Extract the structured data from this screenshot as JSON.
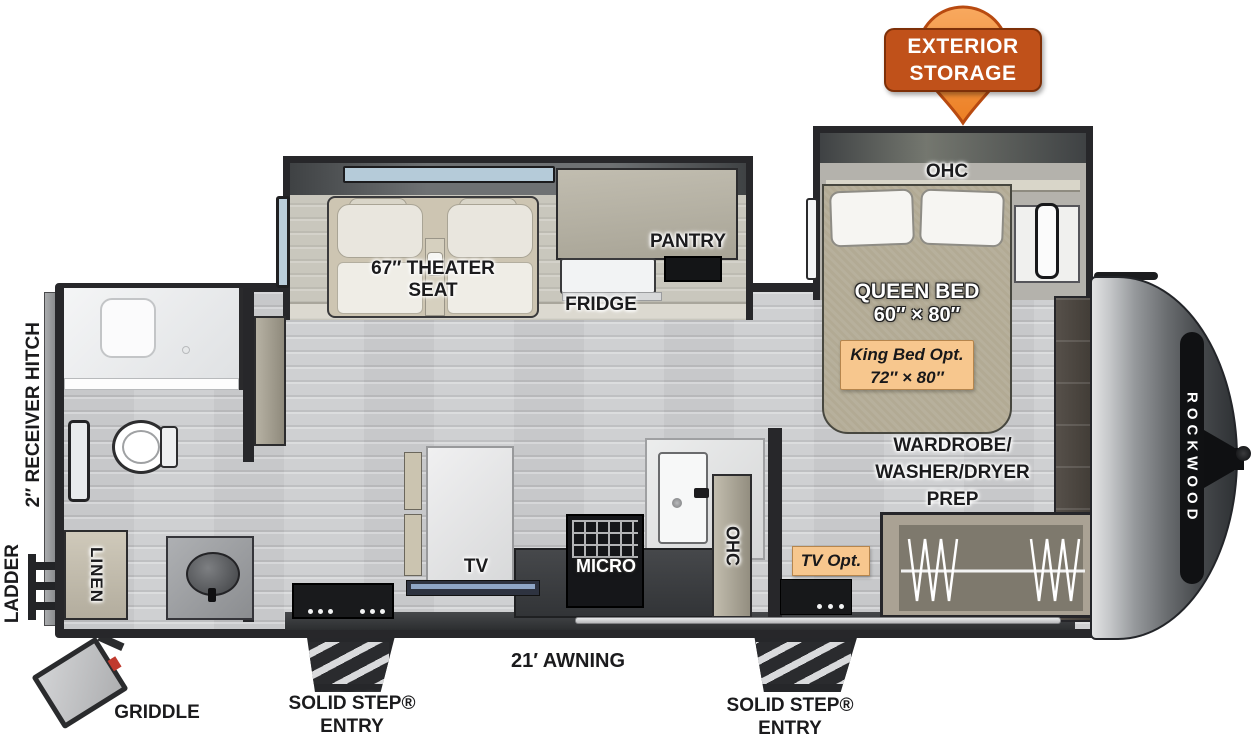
{
  "callout": {
    "lines": [
      "EXTERIOR",
      "STORAGE"
    ]
  },
  "bedroom": {
    "ohc": "OHC",
    "queen_bed": "QUEEN BED",
    "queen_size": "60″ × 80″",
    "king_opt": "King Bed Opt.",
    "king_size": "72″ × 80″",
    "wardrobe": [
      "WARDROBE/",
      "WASHER/DRYER",
      "PREP"
    ],
    "tv_opt": "TV Opt."
  },
  "living": {
    "theater": [
      "67″ THEATER",
      "SEAT"
    ],
    "pantry": "PANTRY",
    "fridge": "FRIDGE",
    "tv": "TV",
    "micro": "MICRO",
    "ohc": "OHC"
  },
  "bath": {
    "linen": "LINEN"
  },
  "exterior": {
    "ladder": "LADDER",
    "hitch": "2″ RECEIVER HITCH",
    "griddle": "GRIDDLE",
    "awning": "21′ AWNING",
    "entry": [
      "SOLID STEP®",
      "ENTRY"
    ],
    "brand": "ROCKWOOD"
  },
  "colors": {
    "callout_fill": "#f29a4d",
    "callout_box": "#c0511a",
    "accent_tan": "#f7c78e",
    "wall": "#27272a",
    "floor": "#cfd0d2"
  }
}
